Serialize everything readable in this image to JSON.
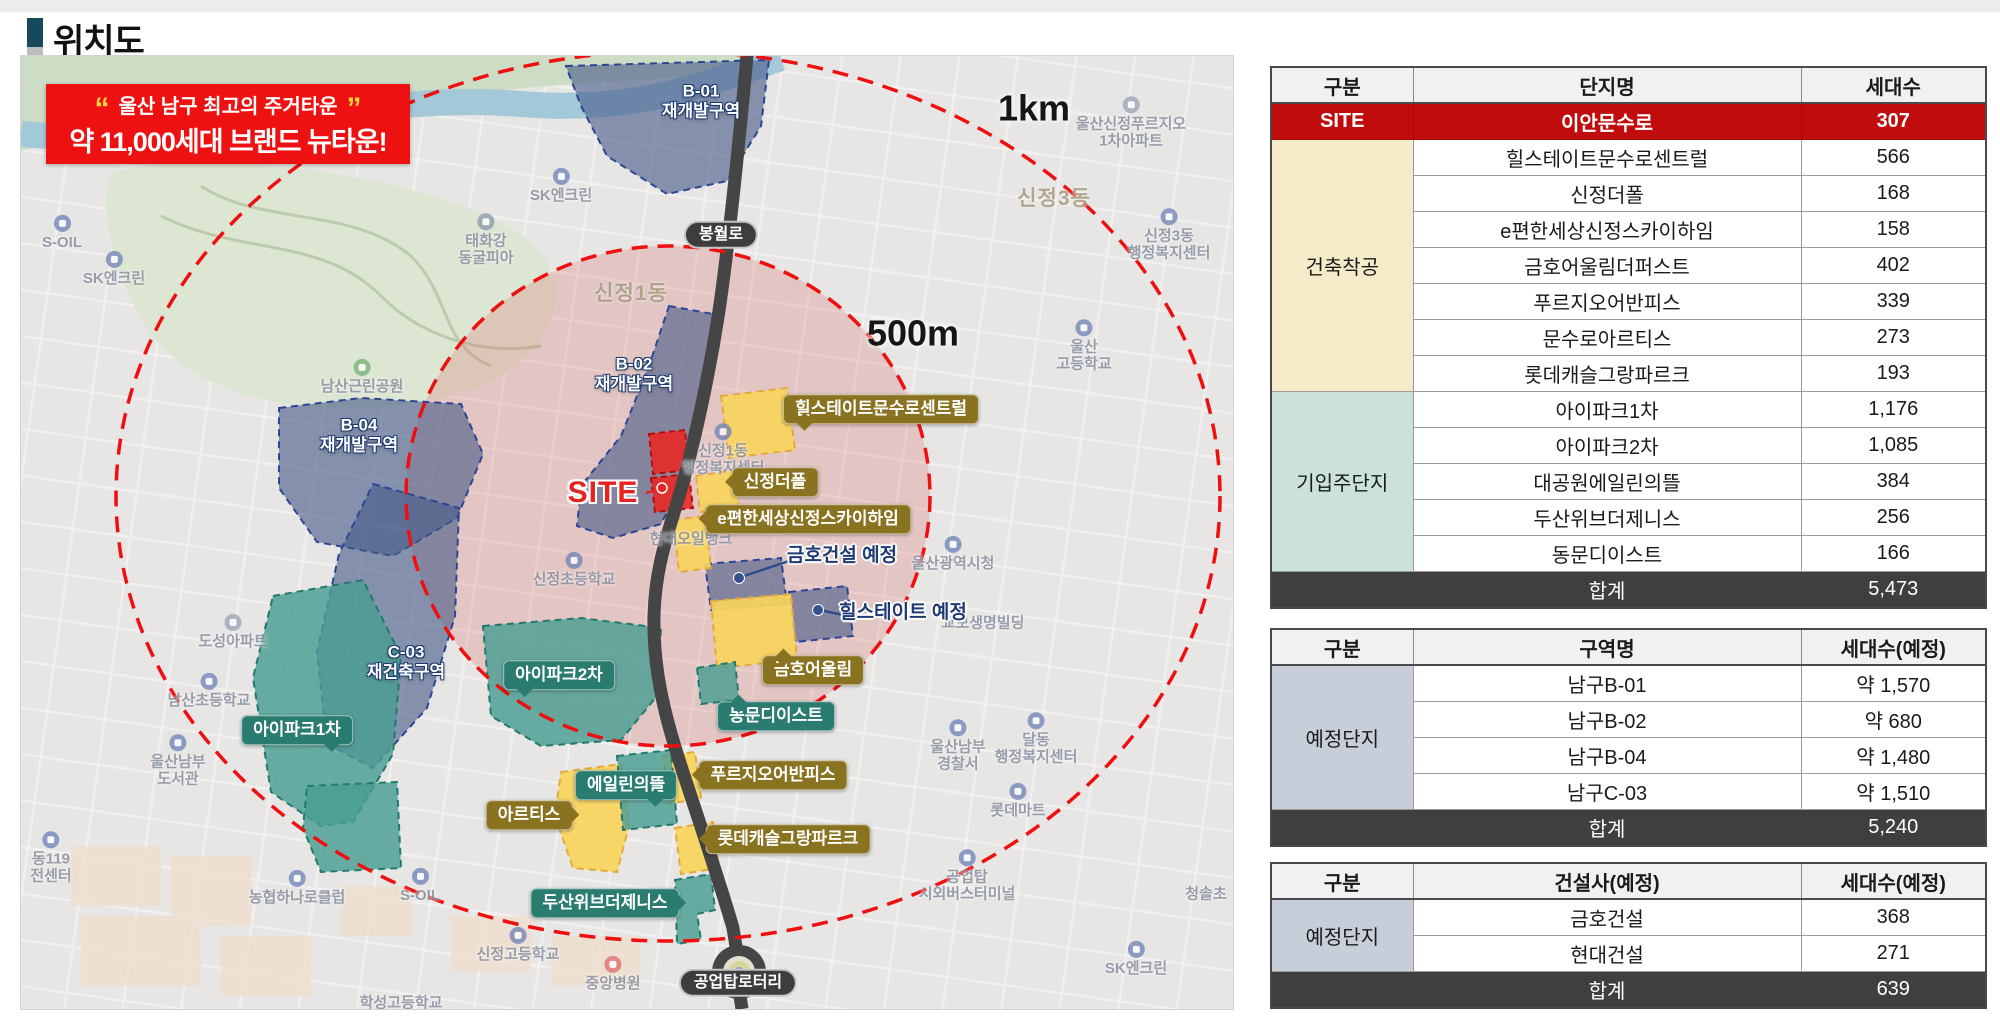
{
  "page": {
    "title": "위치도"
  },
  "banner": {
    "quote_open": "“",
    "line1": "울산 남구 최고의 주거타운",
    "quote_close": "”",
    "line2": "약 11,000세대 브랜드 뉴타운!"
  },
  "colors": {
    "banner_bg": "#ee1111",
    "quote_yellow": "#ffd83d",
    "site_red": "#c00c0c",
    "olive_label": "#8a7320",
    "teal_label": "#2a7c71",
    "total_bg": "#3f3f3f",
    "group_started_bg": "#f5ebc8",
    "group_movedin_bg": "#cbe2dc",
    "group_planned_bg": "#c7cdd9",
    "ring_red": "#ee1010",
    "zone_navy": "#445887",
    "zone_teal": "#499e92",
    "zone_yellow": "#f9d45c"
  },
  "map": {
    "scale_labels": [
      {
        "text": "500m",
        "x": 892,
        "y": 277
      },
      {
        "text": "1km",
        "x": 1013,
        "y": 52
      }
    ],
    "zone_labels": [
      {
        "lines": [
          "B-01",
          "재개발구역"
        ],
        "x": 680,
        "y": 45
      },
      {
        "lines": [
          "B-02",
          "재개발구역"
        ],
        "x": 613,
        "y": 318
      },
      {
        "lines": [
          "B-04",
          "재개발구역"
        ],
        "x": 338,
        "y": 379
      },
      {
        "lines": [
          "C-03",
          "재건축구역"
        ],
        "x": 385,
        "y": 606
      }
    ],
    "road_labels": [
      {
        "text": "봉월로",
        "x": 700,
        "y": 179
      },
      {
        "text": "공업탑로터리",
        "x": 717,
        "y": 927
      }
    ],
    "site_label": {
      "text": "SITE",
      "x": 582,
      "y": 437
    },
    "callouts": [
      {
        "text": "힐스테이트문수로센트럴",
        "x": 860,
        "y": 353,
        "type": "olive",
        "tail": "bl"
      },
      {
        "text": "신정더폴",
        "x": 754,
        "y": 426,
        "type": "olive",
        "tail": "l"
      },
      {
        "text": "e편한세상신정스카이하임",
        "x": 787,
        "y": 463,
        "type": "olive",
        "tail": "l"
      },
      {
        "text": "금호어울림",
        "x": 792,
        "y": 614,
        "type": "olive",
        "tail": "tl"
      },
      {
        "text": "푸르지오어반피스",
        "x": 752,
        "y": 719,
        "type": "olive",
        "tail": "l"
      },
      {
        "text": "아르티스",
        "x": 508,
        "y": 759,
        "type": "olive",
        "tail": "r"
      },
      {
        "text": "롯데캐슬그랑파르크",
        "x": 767,
        "y": 783,
        "type": "olive",
        "tail": "l"
      },
      {
        "text": "아이파크1차",
        "x": 276,
        "y": 674,
        "type": "teal",
        "tail": "br"
      },
      {
        "text": "아이파크2차",
        "x": 538,
        "y": 619,
        "type": "teal",
        "tail": "bl"
      },
      {
        "text": "동문디이스트",
        "x": 755,
        "y": 660,
        "type": "teal",
        "tail": "tl"
      },
      {
        "text": "에일린의뜰",
        "x": 605,
        "y": 729,
        "type": "teal",
        "tail": "br"
      },
      {
        "text": "두산위브더제니스",
        "x": 584,
        "y": 847,
        "type": "teal",
        "tail": "r"
      }
    ],
    "white_callouts": [
      {
        "text": "금호건설 예정",
        "x": 821,
        "y": 500
      },
      {
        "text": "힐스테이트 예정",
        "x": 882,
        "y": 557
      }
    ],
    "map_labels": [
      {
        "lines": [
          "S-OIL"
        ],
        "x": 41,
        "y": 177,
        "icon": "gas"
      },
      {
        "lines": [
          "SK엔크린"
        ],
        "x": 93,
        "y": 213,
        "icon": "gas"
      },
      {
        "lines": [
          "태화강",
          "동굴피아"
        ],
        "x": 465,
        "y": 184,
        "icon": "poi"
      },
      {
        "lines": [
          "SK엔크린"
        ],
        "x": 540,
        "y": 130,
        "icon": "gas"
      },
      {
        "lines": [
          "신정1동"
        ],
        "x": 610,
        "y": 238,
        "kind": "district"
      },
      {
        "lines": [
          "신정3동"
        ],
        "x": 1033,
        "y": 143,
        "kind": "district"
      },
      {
        "lines": [
          "울산신정푸르지오",
          "1차아파트"
        ],
        "x": 1110,
        "y": 67,
        "icon": "apt"
      },
      {
        "lines": [
          "신정3동",
          "행정복지센터"
        ],
        "x": 1148,
        "y": 179,
        "icon": "gov"
      },
      {
        "lines": [
          "남산근린공원"
        ],
        "x": 341,
        "y": 321,
        "icon": "park"
      },
      {
        "lines": [
          "도성아파트"
        ],
        "x": 212,
        "y": 576,
        "icon": "apt"
      },
      {
        "lines": [
          "남산초등학교"
        ],
        "x": 188,
        "y": 635,
        "icon": "school"
      },
      {
        "lines": [
          "울산남부",
          "도서관"
        ],
        "x": 157,
        "y": 705,
        "icon": "gov"
      },
      {
        "lines": [
          "울산",
          "고등학교"
        ],
        "x": 1063,
        "y": 290,
        "icon": "school"
      },
      {
        "lines": [
          "신정1동",
          "행정복지센터"
        ],
        "x": 702,
        "y": 394,
        "icon": "gov"
      },
      {
        "lines": [
          "현대오일뱅크"
        ],
        "x": 670,
        "y": 483
      },
      {
        "lines": [
          "신정초등학교"
        ],
        "x": 553,
        "y": 514,
        "icon": "school"
      },
      {
        "lines": [
          "울산광역시청"
        ],
        "x": 932,
        "y": 498,
        "icon": "gov"
      },
      {
        "lines": [
          "교보생명빌딩"
        ],
        "x": 962,
        "y": 567
      },
      {
        "lines": [
          "울산남부",
          "경찰서"
        ],
        "x": 937,
        "y": 690,
        "icon": "police"
      },
      {
        "lines": [
          "달동",
          "행정복지센터"
        ],
        "x": 1015,
        "y": 683,
        "icon": "gov"
      },
      {
        "lines": [
          "롯데마트"
        ],
        "x": 997,
        "y": 745,
        "icon": "shop"
      },
      {
        "lines": [
          "청솔초"
        ],
        "x": 1185,
        "y": 838
      },
      {
        "lines": [
          "공업탑",
          "시외버스터미널"
        ],
        "x": 946,
        "y": 820,
        "icon": "bus"
      },
      {
        "lines": [
          "SK엔크린"
        ],
        "x": 1115,
        "y": 903,
        "icon": "gas"
      },
      {
        "lines": [
          "농협하나로클럽"
        ],
        "x": 276,
        "y": 832,
        "icon": "shop"
      },
      {
        "lines": [
          "S-OIL"
        ],
        "x": 399,
        "y": 830,
        "icon": "gas"
      },
      {
        "lines": [
          "동119",
          "전센터"
        ],
        "x": 30,
        "y": 802,
        "icon": "fire"
      },
      {
        "lines": [
          "신정고등학교"
        ],
        "x": 497,
        "y": 889,
        "icon": "school"
      },
      {
        "lines": [
          "중앙병원"
        ],
        "x": 592,
        "y": 918,
        "icon": "hospital"
      },
      {
        "lines": [
          "학성고등학교"
        ],
        "x": 380,
        "y": 947
      }
    ]
  },
  "tables": [
    {
      "name": "complex-table",
      "headers": [
        "구분",
        "단지명",
        "세대수"
      ],
      "groups": [
        {
          "label": "SITE",
          "type": "site",
          "rows": [
            [
              "이안문수로",
              "307"
            ]
          ]
        },
        {
          "label": "건축착공",
          "type": "cream",
          "rows": [
            [
              "힐스테이트문수로센트럴",
              "566"
            ],
            [
              "신정더폴",
              "168"
            ],
            [
              "e편한세상신정스카이하임",
              "158"
            ],
            [
              "금호어울림더퍼스트",
              "402"
            ],
            [
              "푸르지오어반피스",
              "339"
            ],
            [
              "문수로아르티스",
              "273"
            ],
            [
              "롯데캐슬그랑파르크",
              "193"
            ]
          ]
        },
        {
          "label": "기입주단지",
          "type": "teal",
          "rows": [
            [
              "아이파크1차",
              "1,176"
            ],
            [
              "아이파크2차",
              "1,085"
            ],
            [
              "대공원에일린의뜰",
              "384"
            ],
            [
              "두산위브더제니스",
              "256"
            ],
            [
              "동문디이스트",
              "166"
            ]
          ]
        }
      ],
      "total": {
        "label": "합계",
        "value": "5,473"
      }
    },
    {
      "name": "planned-zone-table",
      "headers": [
        "구분",
        "구역명",
        "세대수(예정)"
      ],
      "groups": [
        {
          "label": "예정단지",
          "type": "lav",
          "rows": [
            [
              "남구B-01",
              "약 1,570"
            ],
            [
              "남구B-02",
              "약 680"
            ],
            [
              "남구B-04",
              "약 1,480"
            ],
            [
              "남구C-03",
              "약 1,510"
            ]
          ]
        }
      ],
      "total": {
        "label": "합계",
        "value": "5,240"
      }
    },
    {
      "name": "planned-builder-table",
      "headers": [
        "구분",
        "건설사(예정)",
        "세대수(예정)"
      ],
      "groups": [
        {
          "label": "예정단지",
          "type": "lav",
          "rows": [
            [
              "금호건설",
              "368"
            ],
            [
              "현대건설",
              "271"
            ]
          ]
        }
      ],
      "total": {
        "label": "합계",
        "value": "639"
      }
    }
  ]
}
